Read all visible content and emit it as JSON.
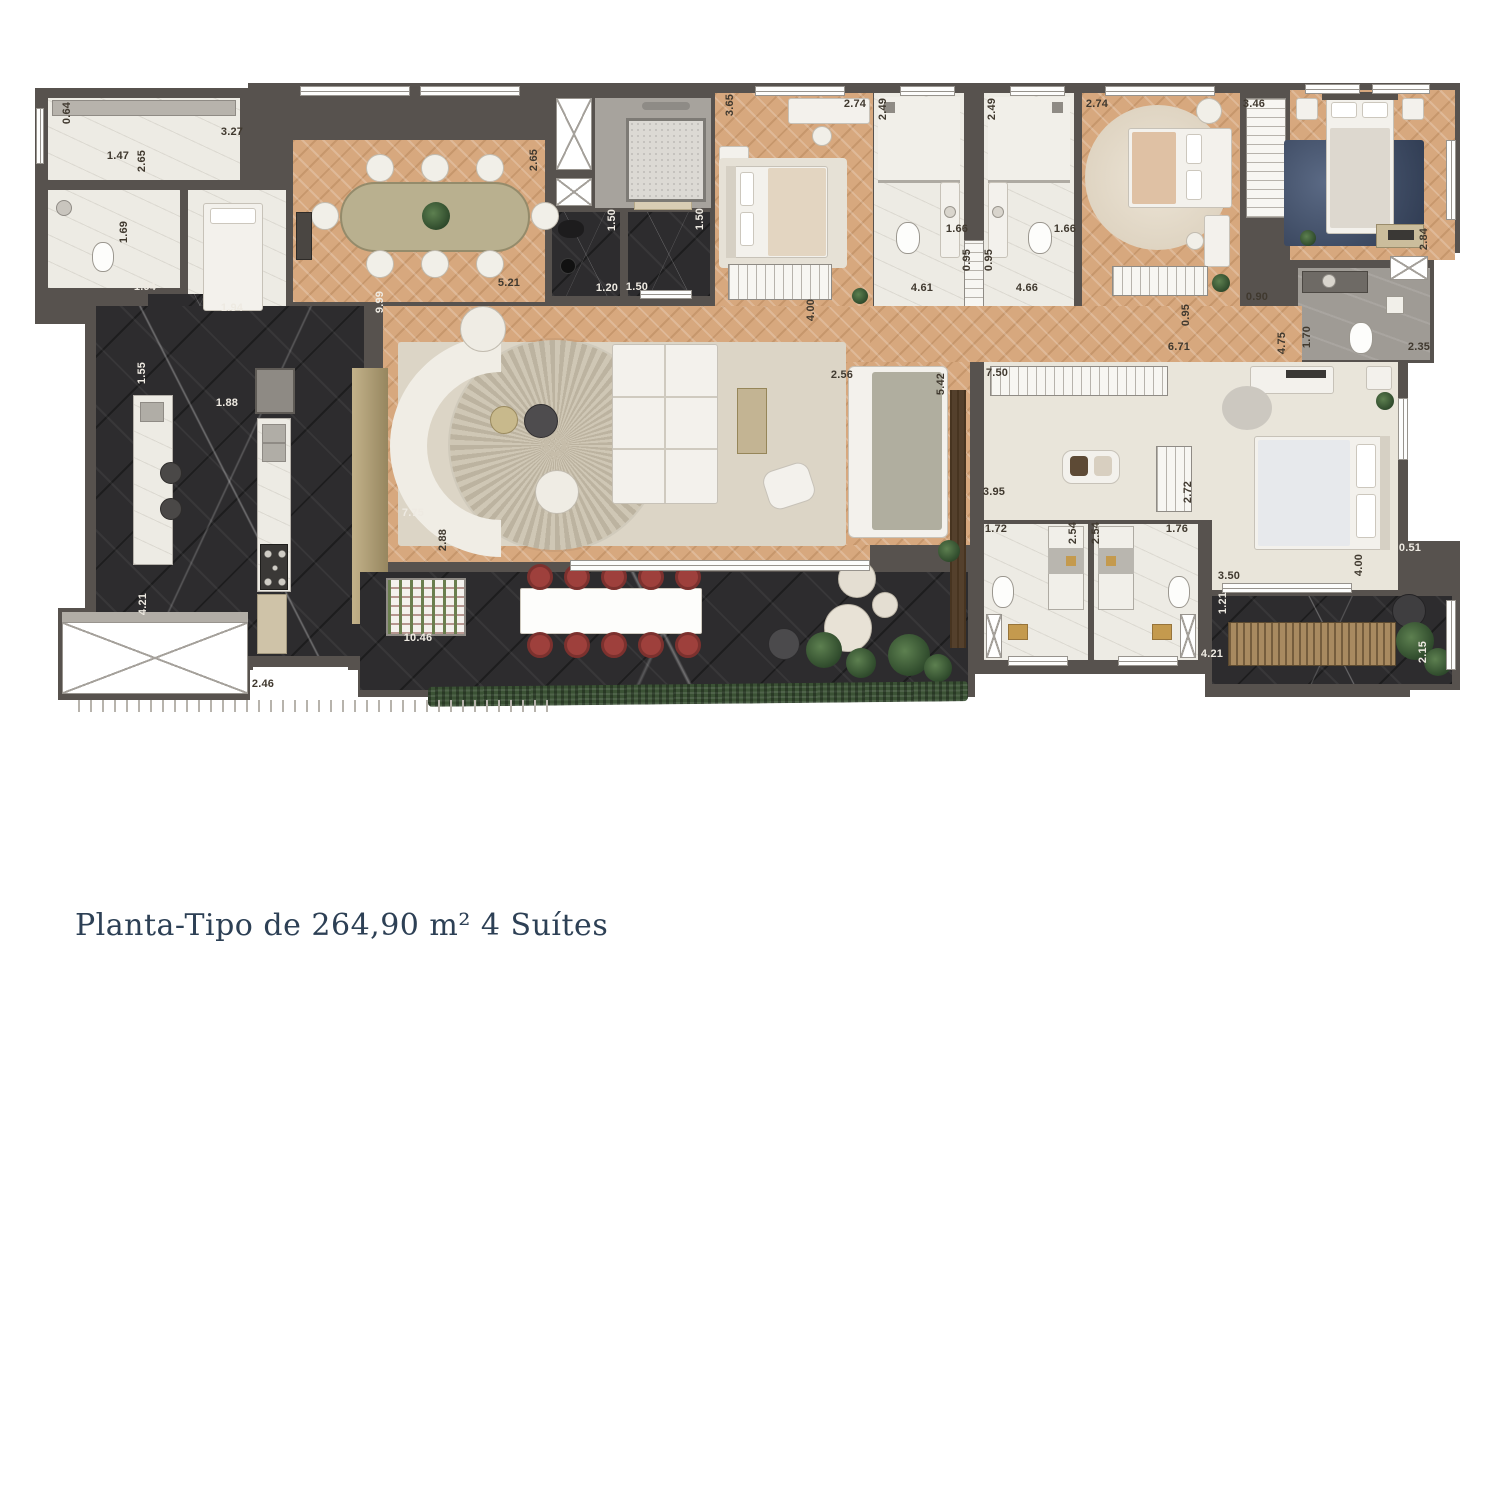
{
  "caption": {
    "text": "Planta-Tipo de 264,90 m² 4 Suítes",
    "color": "#2d4055"
  },
  "plan": {
    "colors": {
      "wall": "#57524e",
      "wood_floor": "#d7a87e",
      "dark_marble": "#2d2c2e",
      "white_marble": "#edebe4",
      "carpet_cream": "#e9e5da",
      "rug_beige": "#dcd5c6",
      "chair_red": "#9e403c",
      "hedge_green": "#3b5235",
      "caption_blue": "#2d4055"
    },
    "dimensions": [
      {
        "t": "0.64",
        "x": 67,
        "y": 113,
        "r": 1,
        "c": 0
      },
      {
        "t": "3.27",
        "x": 232,
        "y": 132,
        "r": 0,
        "c": 0
      },
      {
        "t": "1.47",
        "x": 118,
        "y": 156,
        "r": 0,
        "c": 0
      },
      {
        "t": "2.65",
        "x": 142,
        "y": 161,
        "r": 1,
        "c": 0
      },
      {
        "t": "1.69",
        "x": 124,
        "y": 232,
        "r": 1,
        "c": 0
      },
      {
        "t": "1.94",
        "x": 145,
        "y": 287,
        "r": 0,
        "c": 1
      },
      {
        "t": "1.94",
        "x": 232,
        "y": 308,
        "r": 0,
        "c": 1
      },
      {
        "t": "2.65",
        "x": 534,
        "y": 160,
        "r": 1,
        "c": 0
      },
      {
        "t": "5.21",
        "x": 509,
        "y": 283,
        "r": 0,
        "c": 0
      },
      {
        "t": "9.99",
        "x": 380,
        "y": 302,
        "r": 1,
        "c": 1
      },
      {
        "t": "1.50",
        "x": 612,
        "y": 220,
        "r": 1,
        "c": 1
      },
      {
        "t": "1.50",
        "x": 700,
        "y": 219,
        "r": 1,
        "c": 1
      },
      {
        "t": "1.20",
        "x": 607,
        "y": 288,
        "r": 0,
        "c": 1
      },
      {
        "t": "1.50",
        "x": 637,
        "y": 287,
        "r": 0,
        "c": 1
      },
      {
        "t": "3.65",
        "x": 730,
        "y": 105,
        "r": 1,
        "c": 0
      },
      {
        "t": "2.74",
        "x": 855,
        "y": 104,
        "r": 0,
        "c": 0
      },
      {
        "t": "4.61",
        "x": 922,
        "y": 288,
        "r": 0,
        "c": 0
      },
      {
        "t": "2.49",
        "x": 883,
        "y": 109,
        "r": 1,
        "c": 0
      },
      {
        "t": "1.66",
        "x": 957,
        "y": 229,
        "r": 0,
        "c": 0
      },
      {
        "t": "0.95",
        "x": 967,
        "y": 260,
        "r": 1,
        "c": 0
      },
      {
        "t": "0.95",
        "x": 989,
        "y": 260,
        "r": 1,
        "c": 0
      },
      {
        "t": "2.49",
        "x": 992,
        "y": 109,
        "r": 1,
        "c": 0
      },
      {
        "t": "1.66",
        "x": 1065,
        "y": 229,
        "r": 0,
        "c": 0
      },
      {
        "t": "4.66",
        "x": 1027,
        "y": 288,
        "r": 0,
        "c": 0
      },
      {
        "t": "2.74",
        "x": 1097,
        "y": 104,
        "r": 0,
        "c": 0
      },
      {
        "t": "3.46",
        "x": 1254,
        "y": 104,
        "r": 0,
        "c": 0
      },
      {
        "t": "2.84",
        "x": 1424,
        "y": 239,
        "r": 1,
        "c": 0
      },
      {
        "t": "0.90",
        "x": 1257,
        "y": 297,
        "r": 0,
        "c": 0
      },
      {
        "t": "1.70",
        "x": 1307,
        "y": 337,
        "r": 1,
        "c": 0
      },
      {
        "t": "2.35",
        "x": 1419,
        "y": 347,
        "r": 0,
        "c": 0
      },
      {
        "t": "4.00",
        "x": 811,
        "y": 310,
        "r": 1,
        "c": 0
      },
      {
        "t": "0.95",
        "x": 1186,
        "y": 315,
        "r": 1,
        "c": 0
      },
      {
        "t": "6.71",
        "x": 1179,
        "y": 347,
        "r": 0,
        "c": 0
      },
      {
        "t": "4.75",
        "x": 1282,
        "y": 343,
        "r": 1,
        "c": 0
      },
      {
        "t": "7.75",
        "x": 413,
        "y": 513,
        "r": 0,
        "c": 1
      },
      {
        "t": "2.88",
        "x": 443,
        "y": 540,
        "r": 1,
        "c": 0
      },
      {
        "t": "10.46",
        "x": 418,
        "y": 638,
        "r": 0,
        "c": 1
      },
      {
        "t": "1.55",
        "x": 142,
        "y": 373,
        "r": 1,
        "c": 1
      },
      {
        "t": "1.88",
        "x": 227,
        "y": 403,
        "r": 0,
        "c": 1
      },
      {
        "t": "4.21",
        "x": 143,
        "y": 604,
        "r": 1,
        "c": 1
      },
      {
        "t": "2.46",
        "x": 263,
        "y": 684,
        "r": 0,
        "c": 0
      },
      {
        "t": "2.56",
        "x": 842,
        "y": 375,
        "r": 0,
        "c": 0
      },
      {
        "t": "5.42",
        "x": 941,
        "y": 384,
        "r": 1,
        "c": 0
      },
      {
        "t": "7.50",
        "x": 997,
        "y": 373,
        "r": 0,
        "c": 0
      },
      {
        "t": "3.95",
        "x": 994,
        "y": 492,
        "r": 0,
        "c": 0
      },
      {
        "t": "1.72",
        "x": 996,
        "y": 529,
        "r": 0,
        "c": 0
      },
      {
        "t": "2.54",
        "x": 1073,
        "y": 533,
        "r": 1,
        "c": 0
      },
      {
        "t": "2.54",
        "x": 1096,
        "y": 533,
        "r": 1,
        "c": 0
      },
      {
        "t": "1.76",
        "x": 1177,
        "y": 529,
        "r": 0,
        "c": 0
      },
      {
        "t": "2.72",
        "x": 1188,
        "y": 492,
        "r": 1,
        "c": 0
      },
      {
        "t": "3.50",
        "x": 1229,
        "y": 576,
        "r": 0,
        "c": 0
      },
      {
        "t": "4.00",
        "x": 1359,
        "y": 565,
        "r": 1,
        "c": 0
      },
      {
        "t": "0.51",
        "x": 1410,
        "y": 548,
        "r": 0,
        "c": 1
      },
      {
        "t": "1.21",
        "x": 1223,
        "y": 603,
        "r": 1,
        "c": 1
      },
      {
        "t": "4.21",
        "x": 1212,
        "y": 654,
        "r": 0,
        "c": 1
      },
      {
        "t": "2.15",
        "x": 1423,
        "y": 652,
        "r": 1,
        "c": 1
      }
    ]
  }
}
